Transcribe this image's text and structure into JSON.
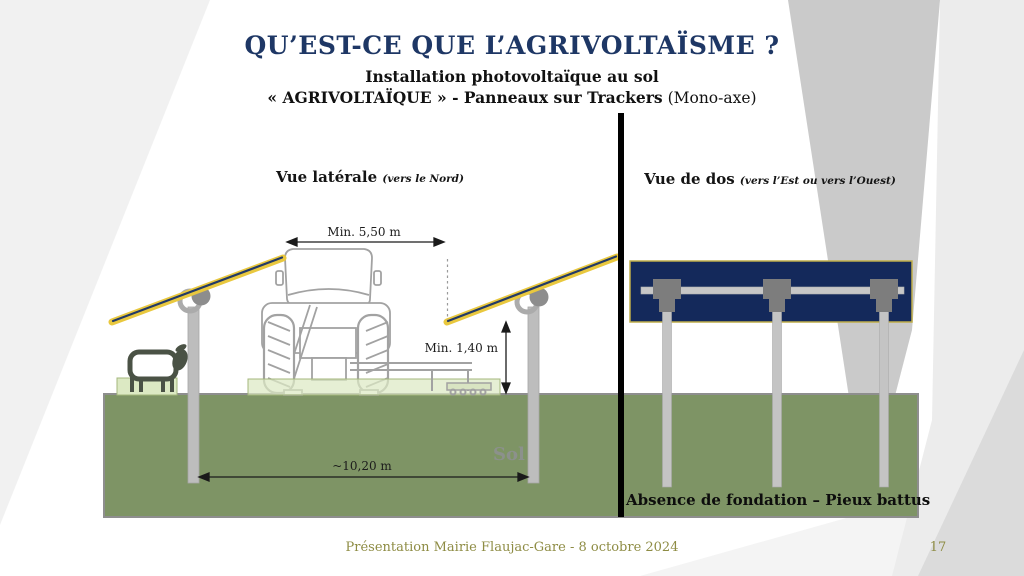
{
  "slide": {
    "title": "QU’EST-CE QUE L’AGRIVOLTAÏSME ?",
    "subtitle_line1": "Installation photovoltaïque au sol",
    "subtitle_line2_bold": "« AGRIVOLTAÏQUE » - Panneaux sur Trackers",
    "subtitle_line2_regular": " (Mono-axe)",
    "footer_text": "Présentation Mairie Flaujac-Gare - 8 octobre 2024",
    "page_number": "17"
  },
  "left_view": {
    "title": "Vue latérale",
    "subtitle": "(vers le Nord)",
    "dim_clearance_width": "Min. 5,50 m",
    "dim_clearance_height": "Min. 1,40 m",
    "dim_post_spacing": "~10,20 m",
    "ground_label": "Sol"
  },
  "right_view": {
    "title": "Vue de dos",
    "subtitle": "(vers l’Est ou vers l’Ouest)",
    "caption": "Absence de fondation – Pieux battus"
  },
  "colors": {
    "title_navy": "#1e3765",
    "panel_navy": "#14295b",
    "tracker_yellow": "#e9c83e",
    "soil_green": "#7e9465",
    "vegetation_green": "#dce9c3",
    "post_gray": "#bdbdbd",
    "bracket_gray": "#7d7d7d",
    "footer_olive": "#8e8c44"
  }
}
